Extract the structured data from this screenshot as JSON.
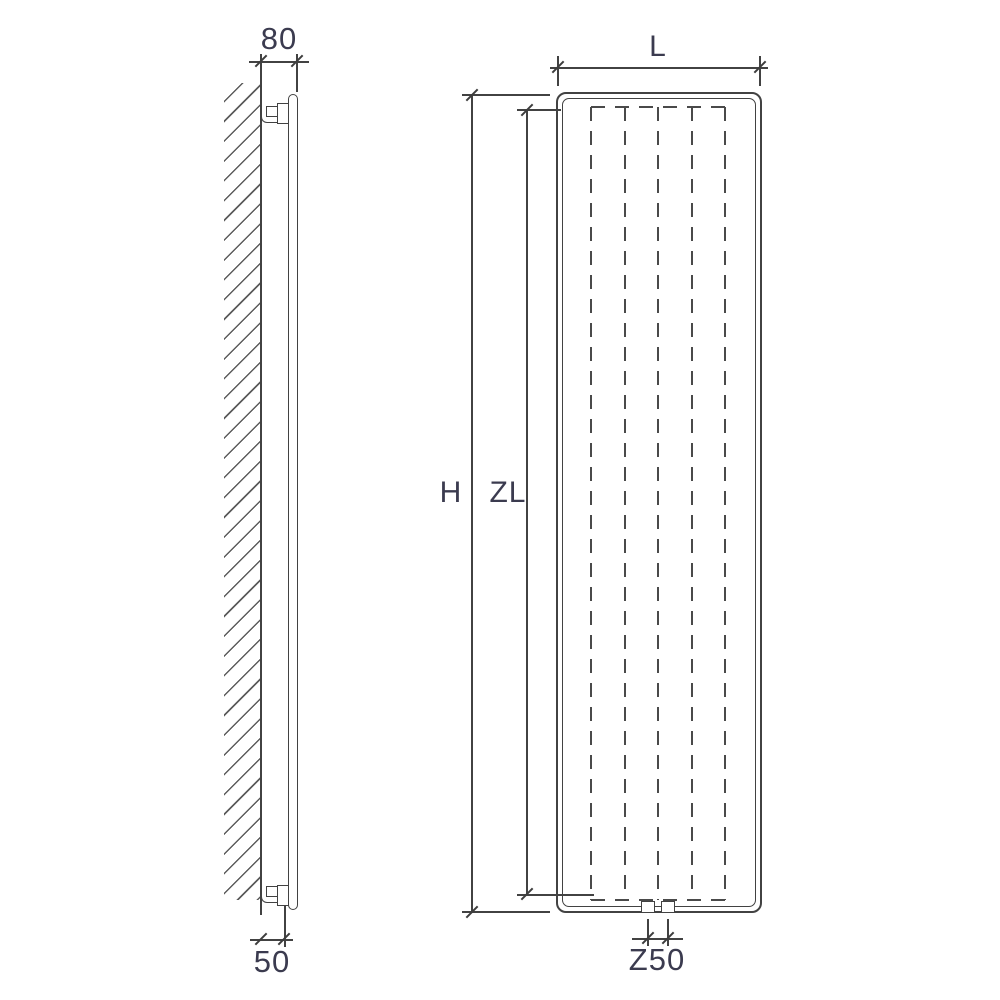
{
  "drawing": {
    "colors": {
      "line": "#424242",
      "label": "#3b3b4f",
      "background": "#ffffff"
    },
    "side_view": {
      "depth": "80",
      "pipe_offset": "50"
    },
    "front_view": {
      "width": "L",
      "height": "H",
      "inner_height": "ZL",
      "connection_spacing": "Z50"
    }
  }
}
